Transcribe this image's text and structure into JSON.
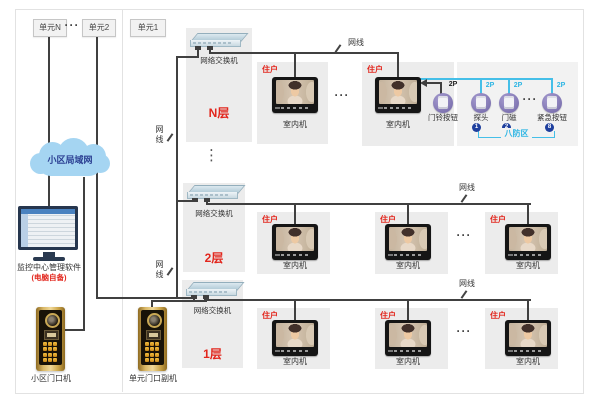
{
  "units": {
    "n": "单元N",
    "u2": "单元2",
    "u1": "单元1",
    "dots": "···"
  },
  "cloud": {
    "label": "小区局域网"
  },
  "pc": {
    "label": "监控中心管理软件",
    "note": "(电脑自备)"
  },
  "doors": {
    "community": "小区门口机",
    "unit_sub": "单元门口副机"
  },
  "common": {
    "switch_label": "网络交换机",
    "cable_label": "网线",
    "resident_tag": "住户",
    "monitor_label": "室内机",
    "h_dots": "···",
    "v_dots": "⋮"
  },
  "floors": {
    "fn": "N层",
    "f2": "2层",
    "f1": "1层"
  },
  "security": {
    "port": "2P",
    "doorbell": "门铃按钮",
    "probe": "探头",
    "magnet": "门磁",
    "emergency": "紧急按钮",
    "zone": "八防区",
    "dots": "···",
    "badge1": "1",
    "badge2": "2",
    "badge8": "8"
  },
  "colors": {
    "accent_red": "#e2261d",
    "cable_cyan": "#45bfe8",
    "badge_blue": "#1e3f9e",
    "cloud_blue": "#a5d5f2",
    "door_gold": "#d9b766"
  }
}
